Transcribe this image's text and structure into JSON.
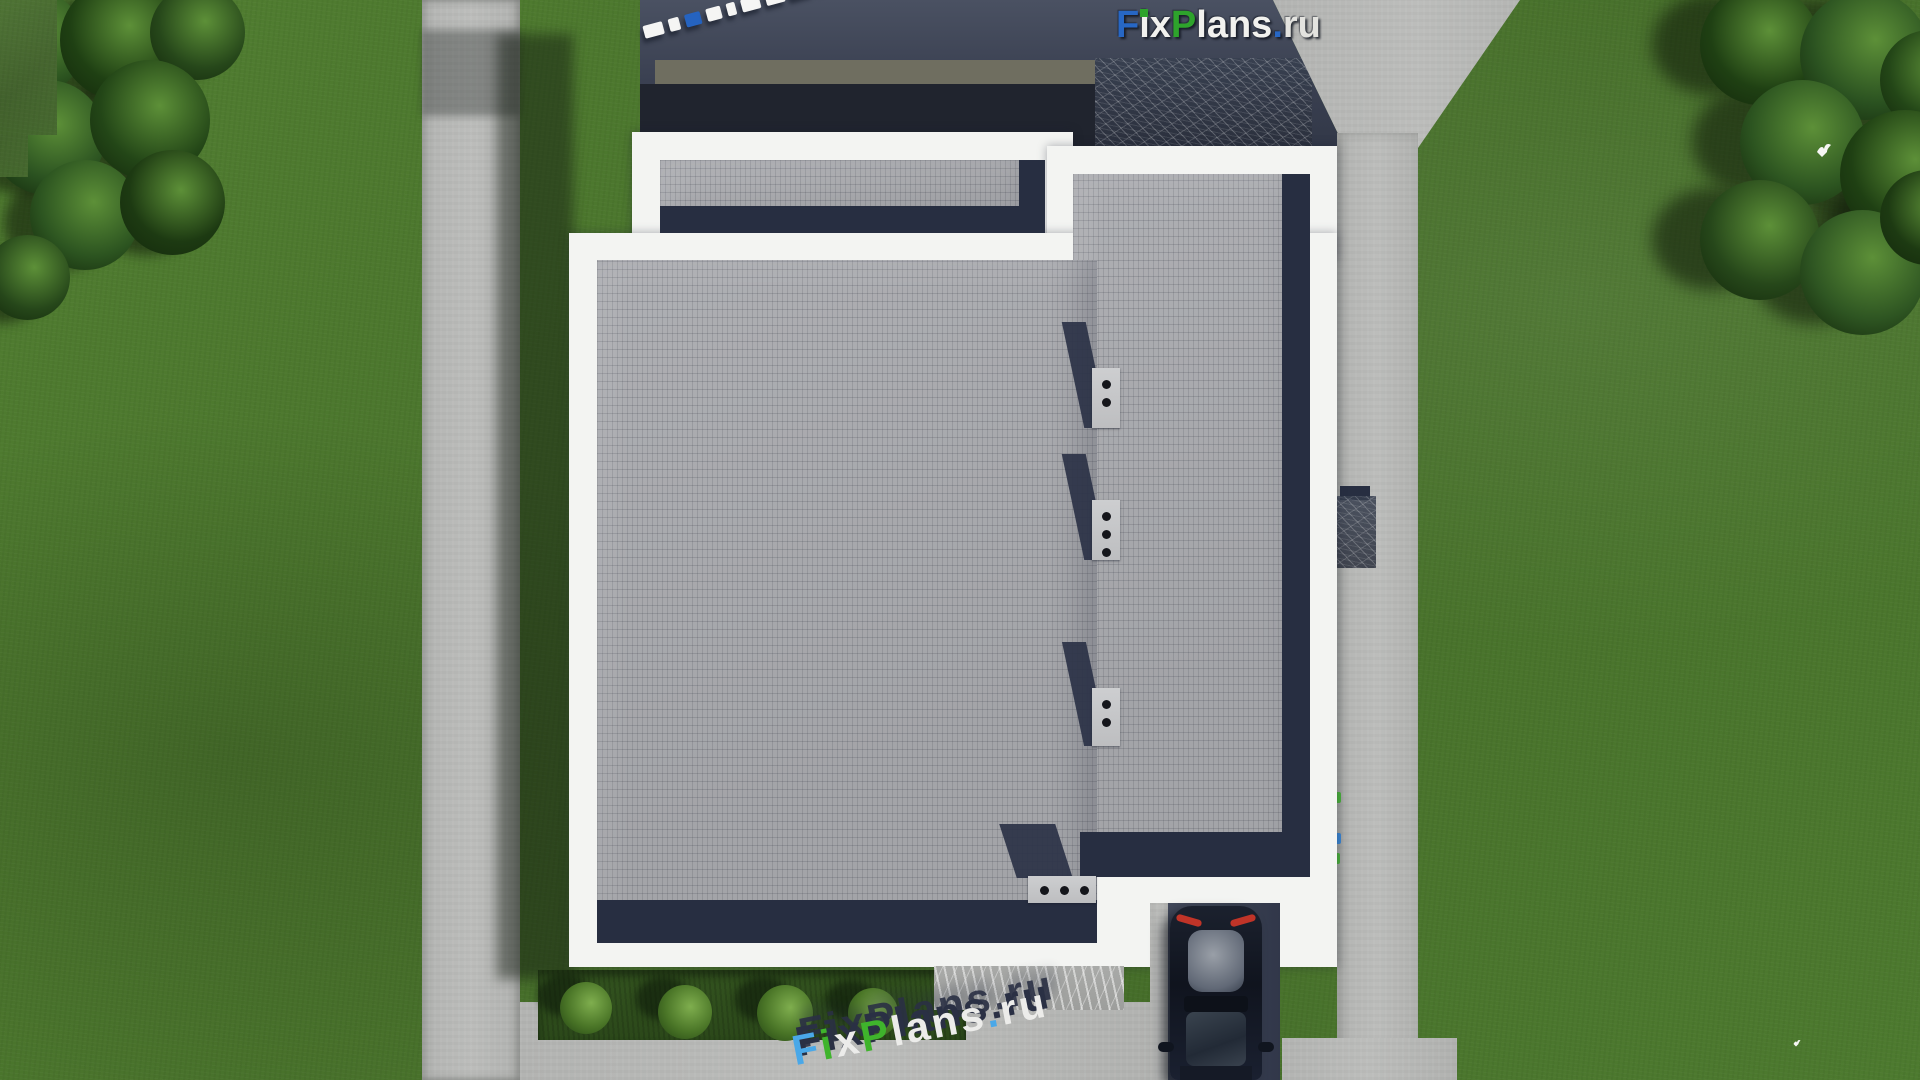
{
  "branding": {
    "logo_full": "FixPlans.ru",
    "logo_f": "F",
    "logo_i": "i",
    "logo_x": "x",
    "logo_p": "P",
    "logo_lans": "lans",
    "logo_dot": ".",
    "logo_ru": "ru"
  },
  "watermark_bottom": {
    "full": "FixPlans.ru",
    "f": "F",
    "i": "i",
    "x": "x",
    "p": "P",
    "lans": "lans",
    "dot": ".",
    "ru": "ru"
  },
  "watermark_top": {
    "block_colors": [
      "#f5f5f4",
      "#f5f5f4",
      "#2563c0",
      "#f5f5f4",
      "#f5f5f4",
      "#f5f5f4",
      "#f5f5f4",
      "#37a32e"
    ],
    "block_widths": [
      20,
      11,
      16,
      15,
      9,
      19,
      19,
      23,
      13
    ]
  },
  "palette": {
    "grass": "#4b7a2e",
    "roof_brick": "#a8a9ad",
    "parapet_white": "#f3f4f2",
    "shadow_navy": "#272e41",
    "canopy_navy": "#3e4455",
    "canopy_dark": "#20242e",
    "fascia_olive": "#6f6e60",
    "pavement": "#b6b7b5",
    "driveway": "#3a4152",
    "car_body": "#161b28",
    "logo_blue": "#2767c5",
    "logo_green": "#2ea32c"
  },
  "scene": {
    "vents": [
      {
        "x": 1092,
        "y": 368,
        "w": 28,
        "h": 60,
        "dots": 2,
        "horizontal": false
      },
      {
        "x": 1092,
        "y": 500,
        "w": 28,
        "h": 60,
        "dots": 3,
        "horizontal": false
      },
      {
        "x": 1092,
        "y": 688,
        "w": 28,
        "h": 58,
        "dots": 2,
        "horizontal": false
      },
      {
        "x": 1028,
        "y": 876,
        "w": 68,
        "h": 27,
        "dots": 3,
        "horizontal": true
      }
    ],
    "bushes": [
      {
        "x": 560,
        "y": 982,
        "s": 52
      },
      {
        "x": 658,
        "y": 985,
        "s": 54
      },
      {
        "x": 757,
        "y": 985,
        "s": 56
      },
      {
        "x": 848,
        "y": 988,
        "s": 50
      }
    ],
    "trees_top_left": [
      {
        "x": -20,
        "y": -10,
        "s": 105,
        "c": "#2c5420"
      },
      {
        "x": 60,
        "y": -20,
        "s": 120,
        "c": "#1f4013"
      },
      {
        "x": 150,
        "y": -15,
        "s": 95,
        "c": "#26471a"
      },
      {
        "x": -10,
        "y": 80,
        "s": 115,
        "c": "#2a5120"
      },
      {
        "x": 90,
        "y": 60,
        "s": 120,
        "c": "#234617"
      },
      {
        "x": 30,
        "y": 160,
        "s": 110,
        "c": "#2c5420"
      },
      {
        "x": 120,
        "y": 150,
        "s": 105,
        "c": "#1d3a12"
      },
      {
        "x": -15,
        "y": 235,
        "s": 85,
        "c": "#26471a"
      }
    ],
    "trees_top_right": [
      {
        "x": 1700,
        "y": -15,
        "s": 120,
        "c": "#1f4013"
      },
      {
        "x": 1800,
        "y": -10,
        "s": 130,
        "c": "#2a5120"
      },
      {
        "x": 1880,
        "y": 30,
        "s": 100,
        "c": "#234617"
      },
      {
        "x": 1740,
        "y": 80,
        "s": 125,
        "c": "#2c5420"
      },
      {
        "x": 1840,
        "y": 110,
        "s": 130,
        "c": "#1f4013"
      },
      {
        "x": 1700,
        "y": 180,
        "s": 120,
        "c": "#26471a"
      },
      {
        "x": 1800,
        "y": 210,
        "s": 125,
        "c": "#2e5522"
      },
      {
        "x": 1880,
        "y": 170,
        "s": 95,
        "c": "#1d3a12"
      }
    ],
    "path_specks": [
      {
        "x": 1334,
        "y": 792,
        "c": "#3fae2f"
      },
      {
        "x": 1334,
        "y": 833,
        "c": "#2e7fd4"
      },
      {
        "x": 1333,
        "y": 853,
        "c": "#3fae2f"
      }
    ],
    "birds": [
      {
        "x": 1814,
        "y": 142,
        "s": 20
      },
      {
        "x": 1792,
        "y": 1034,
        "s": 10
      }
    ]
  }
}
